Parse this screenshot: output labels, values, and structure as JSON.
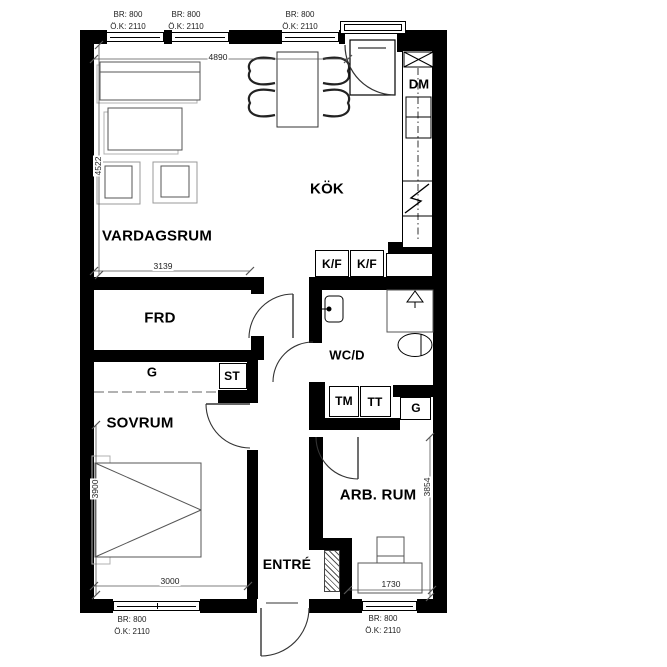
{
  "rooms": {
    "kok": "KÖK",
    "vardagsrum": "VARDAGSRUM",
    "frd": "FRD",
    "sovrum": "SOVRUM",
    "wcd": "WC/D",
    "arbrum": "ARB. RUM",
    "entre": "ENTRÉ"
  },
  "fixtures": {
    "dm": "DM",
    "kf1": "K/F",
    "kf2": "K/F",
    "tm": "TM",
    "tt": "TT",
    "g_closet": "G",
    "g_wardrobe": "G",
    "st": "ST"
  },
  "dimensions": {
    "top_width": "4890",
    "living_height": "4522",
    "frd_width": "3139",
    "sovrum_height": "3900",
    "sovrum_width": "3000",
    "desk_width": "1730",
    "arbrum_height": "3854"
  },
  "window_labels": [
    {
      "br": "BR: 800",
      "ok": "Ö.K: 2110"
    },
    {
      "br": "BR: 800",
      "ok": "Ö.K: 2110"
    },
    {
      "br": "BR: 800",
      "ok": "Ö.K: 2110"
    },
    {
      "br": "BR: 800",
      "ok": "Ö.K: 2110"
    },
    {
      "br": "BR: 800",
      "ok": "Ö.K: 2110"
    }
  ],
  "symbols": {
    "floor_drain": "drain-triangle-icon",
    "stove": "lightning-icon",
    "wall_cabinet": "crossed-box-icon",
    "toilet": "toilet-oval-icon",
    "washbasin": "sink-icon",
    "bed": "bed-v-icon",
    "coat_rack": "hatched-rack-icon"
  },
  "colors": {
    "wall": "#000000",
    "furniture_line": "#555555",
    "shadow_line": "#b0b0b0",
    "background": "#ffffff"
  }
}
